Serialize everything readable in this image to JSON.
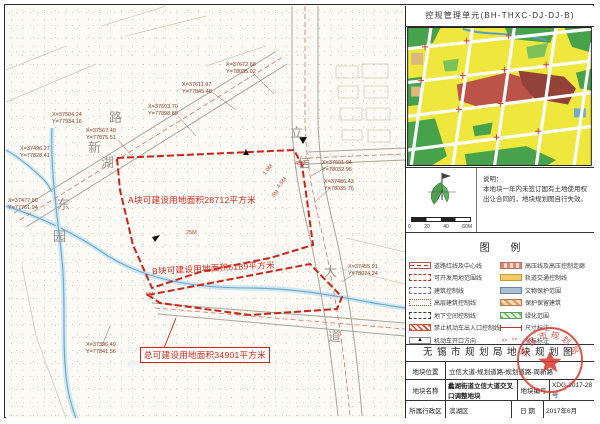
{
  "panel": {
    "title": "控规管理单元(BH-THXC-DJ-DJ-B)",
    "notes": {
      "heading": "说明：",
      "line1": "本地块一年内未签订国有土地使用权",
      "line2": "出让合同的，地块规划图自行失效。"
    },
    "scalebar": {
      "t0": "0",
      "t1": "20",
      "t2": "40",
      "t3": "60M"
    },
    "legend": {
      "title": "图 例",
      "left": [
        "道路红线及中心线",
        "可开发用地范围线",
        "建筑控制线",
        "高层建筑控制线",
        "地下空间控制线",
        "禁止机动车出入口控制线",
        "机动车开口方向"
      ],
      "right": [
        "高压线及高压控制走廊",
        "轨道交通控制线",
        "文物保护范围",
        "保护保留建筑",
        "绿化范围",
        "尺寸标注",
        "坐标标注"
      ],
      "coord_symbol_sample": "X=·· Y=··",
      "opening_symbol": "▲"
    },
    "title_block": {
      "header": "无锡市规划局地块规划图",
      "row1_label": "地块位置",
      "row1_value": "立信大道-规划道路-规划道路-周新路",
      "row2_label": "地块名称",
      "row2_value": "蠡湖街道立信大道交叉口调整地块",
      "row2_label2": "地块编号",
      "row2_value2": "XDG-2017-28号",
      "row3_label": "所属行政区",
      "row3_value": "滨湖区",
      "row3_label2": "日  期",
      "row3_value2": "2017年6月"
    },
    "stamp_text": "无锡市规划局"
  },
  "map": {
    "area_label_a": "A块可建设用地面积28712平方米",
    "area_label_b": "B块可建设用地面积6189平方米",
    "area_label_total": "总可建设用地面积34901平方米",
    "coords": [
      {
        "x": "X=37672.68",
        "y": "Y=78035.02"
      },
      {
        "x": "X=37611.97",
        "y": "Y=77845.48"
      },
      {
        "x": "X=37603.70",
        "y": "Y=77898.89"
      },
      {
        "x": "X=37567.40",
        "y": "Y=77875.51"
      },
      {
        "x": "X=37504.24",
        "y": "Y=77934.16"
      },
      {
        "x": "X=37496.27",
        "y": "Y=77828.41"
      },
      {
        "x": "X=37477.60",
        "y": "Y=77761.94"
      },
      {
        "x": "X=37601.94",
        "y": "Y=78032.96"
      },
      {
        "x": "X=37486.43",
        "y": "Y=78035.76"
      },
      {
        "x": "X=37455.91",
        "y": "Y=78074.24"
      },
      {
        "x": "X=37396.49",
        "y": "Y=77841.56"
      }
    ],
    "road_chars": [
      "路",
      "新",
      "湖",
      "东",
      "园",
      "立",
      "信",
      "大",
      "道"
    ],
    "dims": [
      "45M",
      "1.0M",
      "4.5M",
      "25M",
      "5M",
      "5M"
    ]
  }
}
